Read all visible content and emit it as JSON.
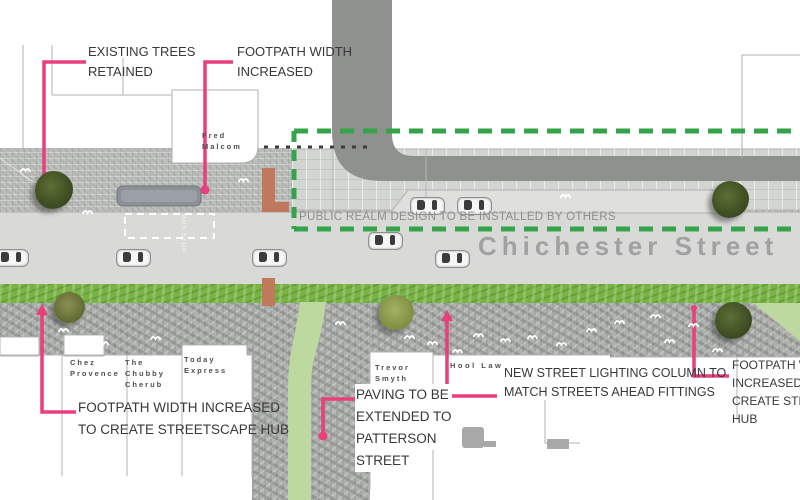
{
  "street": {
    "name": "Chichester Street",
    "bus_stop_text": "BUS STOP"
  },
  "notes": {
    "public_realm": "PUBLIC REALM DESIGN TO BE INSTALLED BY OTHERS",
    "existing_trees": {
      "lines": [
        "EXISTING TREES",
        "RETAINED"
      ]
    },
    "footpath_top": {
      "lines": [
        "FOOTPATH WIDTH",
        "INCREASED"
      ]
    },
    "footpath_left": {
      "lines": [
        "FOOTPATH WIDTH INCREASED",
        "TO CREATE STREETSCAPE HUB"
      ]
    },
    "paving": {
      "lines": [
        "PAVING TO BE",
        "EXTENDED TO",
        "PATTERSON",
        "STREET"
      ]
    },
    "lighting": {
      "lines": [
        "NEW STREET LIGHTING COLUMN TO",
        "MATCH STREETS AHEAD FITTINGS"
      ]
    },
    "footpath_right": {
      "lines": [
        "FOOTPATH WID",
        "INCREASED TO",
        "CREATE STREET",
        "HUB"
      ]
    }
  },
  "buildings": {
    "fred_malcom": {
      "lines": [
        "Fred",
        "Malcom"
      ]
    },
    "chez_provence": {
      "lines": [
        "Chez",
        "Provence"
      ]
    },
    "chubby_cherub": {
      "lines": [
        "The",
        "Chubby",
        "Cherub"
      ]
    },
    "today_express": {
      "lines": [
        "Today",
        "Express"
      ]
    },
    "trevor_smyth": {
      "lines": [
        "Trevor",
        "Smyth",
        "Solicitor"
      ]
    },
    "hool_law": {
      "lines": [
        "Hool Law"
      ]
    }
  },
  "colors": {
    "annotation_pink": "#ea3e7f",
    "dashed_green": "#35a349",
    "grass_green": "#79b344",
    "route_light_green": "#bdd9a0",
    "orange_feature": "#c0795d",
    "road_gray": "#d9dad8",
    "street_text_gray": "#a0a1a1",
    "dark_building_band": "#8f918e"
  },
  "decorations": {
    "trees": [
      {
        "x": 54,
        "y": 190,
        "d": 38,
        "tone": "dark"
      },
      {
        "x": 730,
        "y": 199,
        "d": 37,
        "tone": "dark"
      },
      {
        "x": 69,
        "y": 307,
        "d": 31,
        "tone": "olive"
      },
      {
        "x": 396,
        "y": 312,
        "d": 35,
        "tone": "light"
      },
      {
        "x": 733,
        "y": 320,
        "d": 37,
        "tone": "dark"
      }
    ],
    "cars": [
      {
        "x": 410,
        "y": 197
      },
      {
        "x": 457,
        "y": 197
      },
      {
        "x": -6,
        "y": 249
      },
      {
        "x": 116,
        "y": 249
      },
      {
        "x": 252,
        "y": 249
      },
      {
        "x": 368,
        "y": 232
      },
      {
        "x": 435,
        "y": 250
      }
    ],
    "pedestrian_marks": [
      [
        20,
        160
      ],
      [
        82,
        202
      ],
      [
        238,
        170
      ],
      [
        560,
        186
      ],
      [
        58,
        320
      ],
      [
        98,
        333
      ],
      [
        150,
        328
      ],
      [
        335,
        313
      ],
      [
        404,
        327
      ],
      [
        427,
        333
      ],
      [
        452,
        341
      ],
      [
        473,
        325
      ],
      [
        500,
        330
      ],
      [
        527,
        327
      ],
      [
        556,
        334
      ],
      [
        586,
        320
      ],
      [
        614,
        312
      ],
      [
        650,
        306
      ],
      [
        664,
        331
      ],
      [
        688,
        315
      ],
      [
        712,
        340
      ]
    ]
  }
}
